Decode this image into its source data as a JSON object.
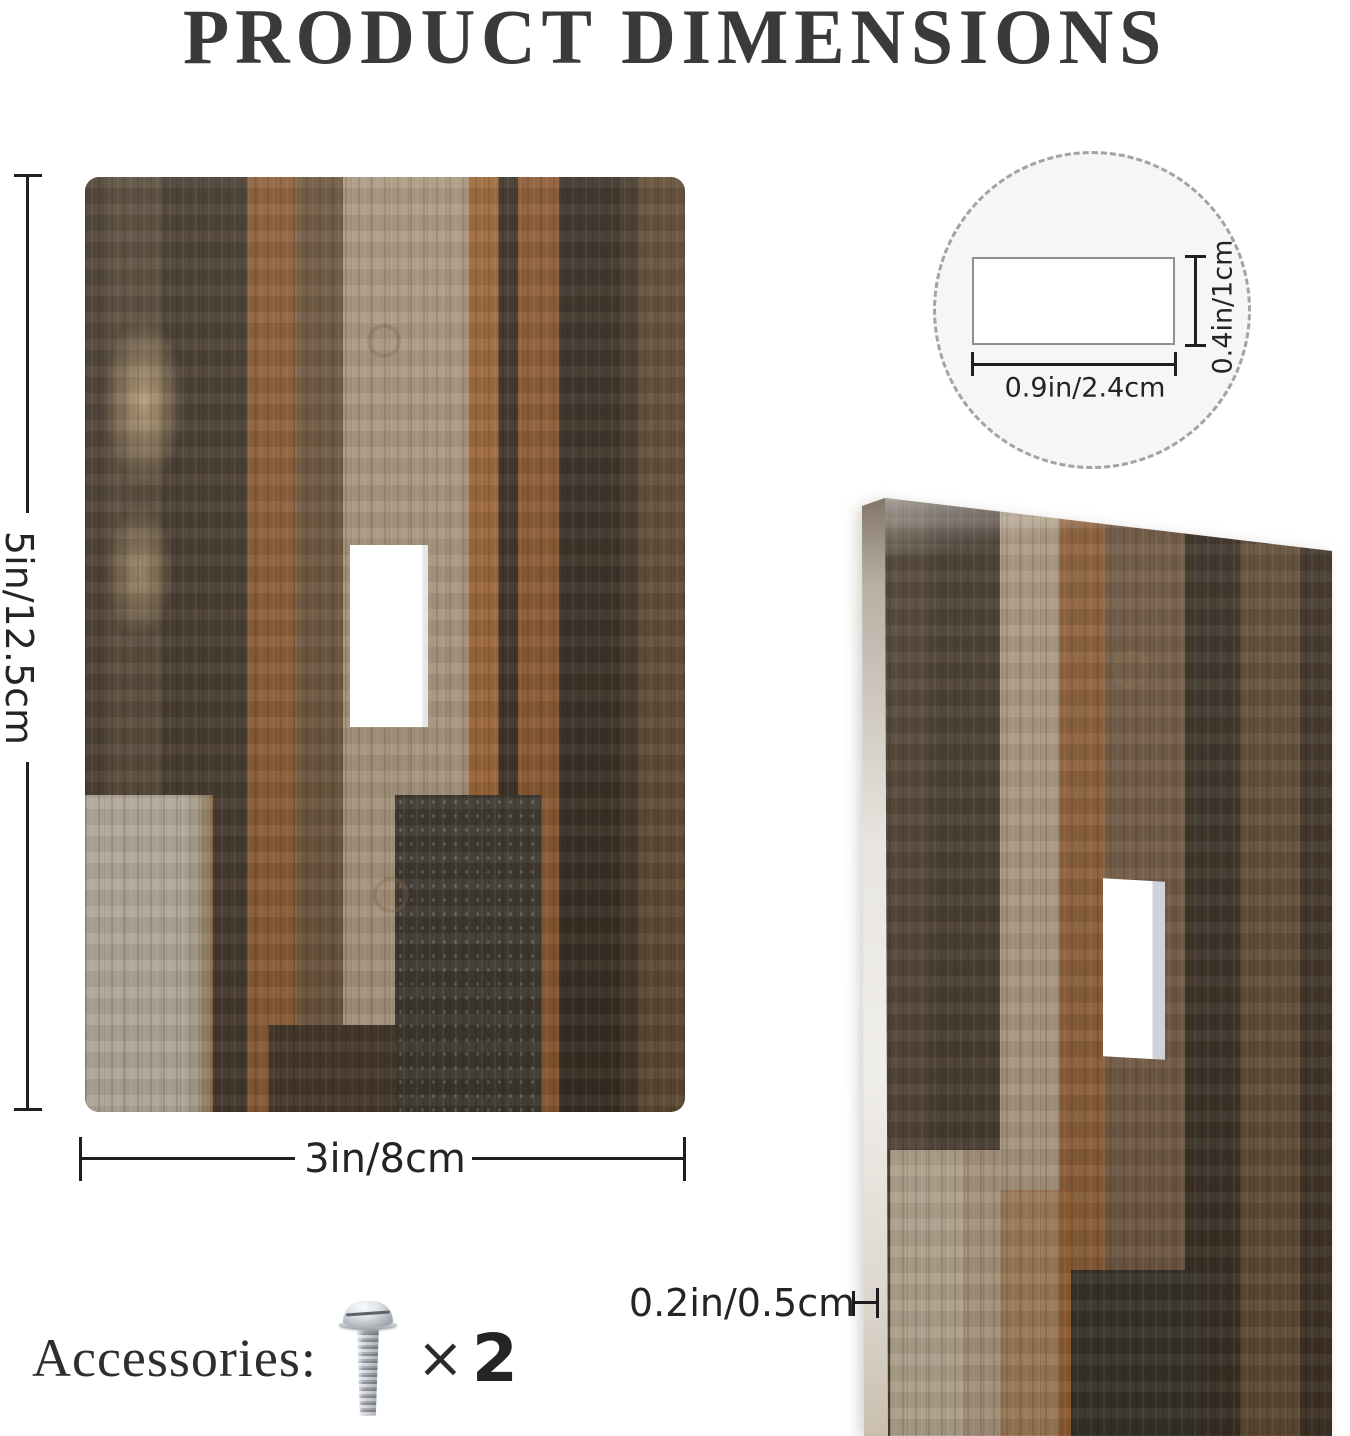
{
  "title": "PRODUCT DIMENSIONS",
  "front_view": {
    "height_label": "5in/12.5cm",
    "width_label": "3in/8cm"
  },
  "hole_detail": {
    "height_label": "0.4in/1cm",
    "width_label": "0.9in/2.4cm"
  },
  "side_view": {
    "thickness_label": "0.2in/0.5cm"
  },
  "accessories": {
    "label": "Accessories:",
    "multiplier": "×",
    "count": "2"
  },
  "colors": {
    "title_text": "#3a3a3c",
    "dimension_lines": "#1f1f1f",
    "detail_circle_fill": "#f6f6f6",
    "wood_dark": "#463a2e",
    "wood_light_plank": "#a8957d",
    "wood_rust": "#8a5c36",
    "plate_edge": "#e9e6e1",
    "screw_metal": "#b0b6bc"
  }
}
